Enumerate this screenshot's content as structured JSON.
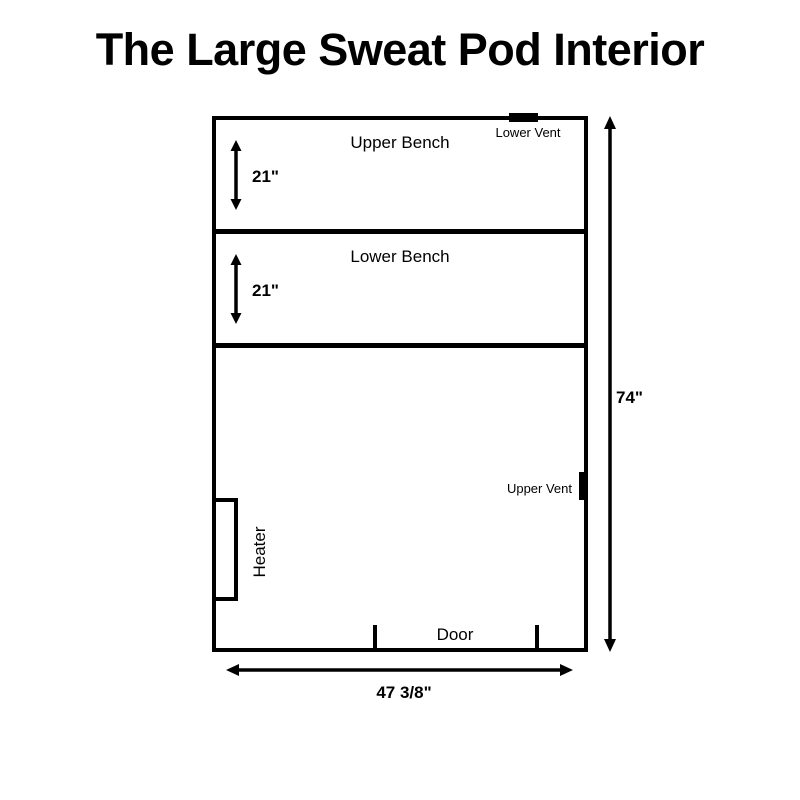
{
  "page": {
    "title": "The Large Sweat Pod Interior",
    "colors": {
      "background": "#ffffff",
      "line": "#000000",
      "text": "#000000"
    }
  },
  "diagram": {
    "pod": {
      "height_label": "74\"",
      "width_label": "47 3/8\""
    },
    "sections": [
      {
        "id": "upper-bench",
        "label": "Upper Bench",
        "depth_label": "21\""
      },
      {
        "id": "lower-bench",
        "label": "Lower Bench",
        "depth_label": "21\""
      }
    ],
    "features": {
      "lower_vent": {
        "label": "Lower Vent"
      },
      "upper_vent": {
        "label": "Upper Vent"
      },
      "heater": {
        "label": "Heater"
      },
      "door": {
        "label": "Door"
      }
    }
  }
}
